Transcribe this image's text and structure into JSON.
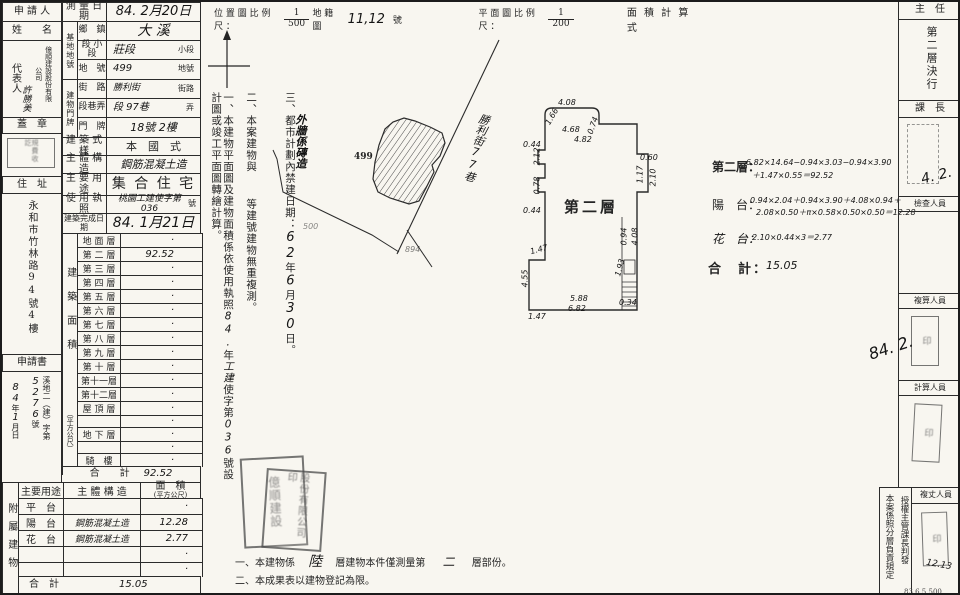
{
  "left": {
    "applicant_label_1": "申 請 人",
    "applicant_label_2": "姓　　名",
    "rep_label": "代表人",
    "company": "億順建設股份有限公司",
    "rep_name": "許勝美",
    "seal_label": "蓋　章",
    "addr_label": "住　址",
    "address": "永和市竹林路94號4樓",
    "application_label": "申請書",
    "application_no_prefix": "溪地二（建）字第",
    "application_no": "5276",
    "application_no_suffix": "號",
    "application_date_y": "84",
    "application_date_y_unit": "年",
    "application_date_m": "1",
    "application_date_m_unit": "月",
    "application_date_d_unit": "日"
  },
  "fields": {
    "survey_date_label": "測 量 日 期",
    "survey_date": "84. 2月20日",
    "site_group_label": "基地地號",
    "town_label": "鄉　鎮",
    "town": "大 溪",
    "section_label": "段 小段",
    "section": "莊段",
    "section_suffix": "小段",
    "parcel_label": "地　號",
    "parcel": "499",
    "parcel_suffix": "地號",
    "bldg_group_label": "建物門牌",
    "street_label": "街　路",
    "street": "勝利街",
    "street_suffix": "街路",
    "lane_label": "段巷弄",
    "lane": "段 97巷",
    "lane_suffix": "弄",
    "door_label": "門　牌",
    "door": "18號  2樓",
    "style_label": "建 築 式 樣",
    "style": "本　國　式",
    "structure_label": "主 體 構 造",
    "structure": "鋼筋混凝土造",
    "use_label": "主 要 用 途",
    "use": "集 合 住 宅",
    "license_label": "使 用 執 照",
    "license": "桃園工建使字第036",
    "license_suffix": "號",
    "complete_label": "建築完成日期",
    "complete_date": "84. 1月21日"
  },
  "area": {
    "group_label": "建築面積",
    "group_sublabel": "（平方公尺）",
    "rows": [
      {
        "label": "地 面 層",
        "value": "·"
      },
      {
        "label": "第 二 層",
        "value": "92.52"
      },
      {
        "label": "第 三 層",
        "value": "·"
      },
      {
        "label": "第 四 層",
        "value": "·"
      },
      {
        "label": "第 五 層",
        "value": "·"
      },
      {
        "label": "第 六 層",
        "value": "·"
      },
      {
        "label": "第 七 層",
        "value": "·"
      },
      {
        "label": "第 八 層",
        "value": "·"
      },
      {
        "label": "第 九 層",
        "value": "·"
      },
      {
        "label": "第 十 層",
        "value": "·"
      },
      {
        "label": "第十一層",
        "value": "·"
      },
      {
        "label": "第十二層",
        "value": "·"
      },
      {
        "label": "屋 頂 層",
        "value": "·"
      },
      {
        "label": "",
        "value": "·"
      },
      {
        "label": "地 下 層",
        "value": "·"
      },
      {
        "label": "",
        "value": "·"
      },
      {
        "label": "騎　樓",
        "value": "·"
      }
    ],
    "total_label": "合　　計",
    "total": "92.52"
  },
  "attached": {
    "group_label": "附屬建物",
    "h_use": "主要用途",
    "h_structure": "主 體 構 造",
    "h_area": "面　積",
    "h_area_sub": "(平方公尺)",
    "rows": [
      {
        "use": "平　台",
        "structure": "",
        "area": "·"
      },
      {
        "use": "陽　台",
        "structure": "鋼筋混凝土造",
        "area": "12.28"
      },
      {
        "use": "花　台",
        "structure": "鋼筋混凝土造",
        "area": "2.77"
      },
      {
        "use": "",
        "structure": "",
        "area": "·"
      },
      {
        "use": "",
        "structure": "",
        "area": "·"
      }
    ],
    "total_label": "合　計",
    "total": "15.05"
  },
  "scales": {
    "location_label": "位 置 圖 比 例 尺 ：",
    "location_num": "1",
    "location_den": "500",
    "cadastral_label": "地 籍 圖",
    "cadastral_no": "11,12",
    "cadastral_suffix": "號",
    "plan_label": "平 面 圖 比 例 尺 ：",
    "plan_num": "1",
    "plan_den": "200",
    "calc_title": "面 積 計 算 式"
  },
  "map": {
    "parcel_label": "499",
    "road_name": "勝利街77巷",
    "parcel_faint_1": "500",
    "parcel_faint_2": "894"
  },
  "notes": {
    "n1_a": "一、本建物平面圖及建物面積係依使用執照",
    "n1_hw1": "84.",
    "n1_b": "年",
    "n1_hw2": "工建",
    "n1_c": "使字第",
    "n1_hw3": "036",
    "n1_d": "號設計圖或竣工平面圖轉繪計算。",
    "n2_a": "二、本案建物與",
    "n2_b": "等建號建物無重複測。",
    "n3_a": "三、都市計劃內禁建日期：",
    "n3_hw1": "62",
    "n3_b": "年",
    "n3_hw2": "6",
    "n3_c": "月",
    "n3_hw3": "30",
    "n3_d": "日。",
    "overlay_hw": "外牆係磚造"
  },
  "plan": {
    "title": "第二層",
    "dims": [
      {
        "t": "4.08",
        "x": 556,
        "y": 96,
        "r": 0
      },
      {
        "t": "1.66",
        "x": 541,
        "y": 110,
        "r": -60
      },
      {
        "t": "4.68",
        "x": 560,
        "y": 123,
        "r": 0
      },
      {
        "t": "0.74",
        "x": 582,
        "y": 119,
        "r": -70
      },
      {
        "t": "4.82",
        "x": 572,
        "y": 133,
        "r": 0
      },
      {
        "t": "0.44",
        "x": 521,
        "y": 138,
        "r": 0
      },
      {
        "t": "2.12",
        "x": 526,
        "y": 150,
        "r": -90
      },
      {
        "t": "0.78",
        "x": 526,
        "y": 179,
        "r": -90
      },
      {
        "t": "0.44",
        "x": 521,
        "y": 204,
        "r": 0
      },
      {
        "t": "1.47",
        "x": 528,
        "y": 243,
        "r": -15
      },
      {
        "t": "4.55",
        "x": 514,
        "y": 272,
        "r": -90
      },
      {
        "t": "1.47",
        "x": 526,
        "y": 310,
        "r": 0
      },
      {
        "t": "5.88",
        "x": 568,
        "y": 292,
        "r": 0
      },
      {
        "t": "6.82",
        "x": 566,
        "y": 302,
        "r": 0
      },
      {
        "t": "0.60",
        "x": 638,
        "y": 151,
        "r": 0
      },
      {
        "t": "1.17",
        "x": 629,
        "y": 168,
        "r": -90
      },
      {
        "t": "2.10",
        "x": 642,
        "y": 171,
        "r": -90
      },
      {
        "t": "0.94",
        "x": 613,
        "y": 230,
        "r": -90
      },
      {
        "t": "4.08",
        "x": 624,
        "y": 230,
        "r": -90
      },
      {
        "t": "1.93",
        "x": 609,
        "y": 261,
        "r": -75
      },
      {
        "t": "0.34",
        "x": 617,
        "y": 296,
        "r": 0
      }
    ]
  },
  "calc": {
    "floor_label": "第二層：",
    "floor_line1": "6.82×14.64−0.94×3.03−0.94×3.90",
    "floor_line2": "＋1.47×0.55＝92.52",
    "balcony_label": "陽　台：",
    "balcony_line1": "0.94×2.04＋0.94×3.90＋4.08×0.94＋",
    "balcony_line2": "2.08×0.50＋π×0.58×0.50×0.50＝12.28",
    "planter_label": "花　台：",
    "planter_line": "2.10×0.44×3＝2.77",
    "total_label": "合　計：",
    "total_value": "15.05"
  },
  "bottom": {
    "n1_a": "一、本建物係",
    "n1_hw1": "陸",
    "n1_b": "層建物本件僅測量第",
    "n1_hw2": "二",
    "n1_c": "層部份。",
    "n2": "二、本成果表以建物登記為限。",
    "print_code": "83.6.5,500"
  },
  "panel": {
    "chief": "主　任",
    "decision": "第二層決行",
    "section_chief": "課　長",
    "date1": "4. 2.",
    "inspector": "檢查人員",
    "recheck": "複算人員",
    "date2": "84. 2.",
    "calculator": "計算人員",
    "surveyor": "複丈人員",
    "date3": "12.13",
    "auth_1": "授權主管課長判發",
    "auth_2": "本案係照分層負責規定"
  },
  "seals": {
    "company_a": "億順建設",
    "company_b": "股份有限公司印",
    "fee_stamp": "規費收訖",
    "name_seal": "印"
  }
}
